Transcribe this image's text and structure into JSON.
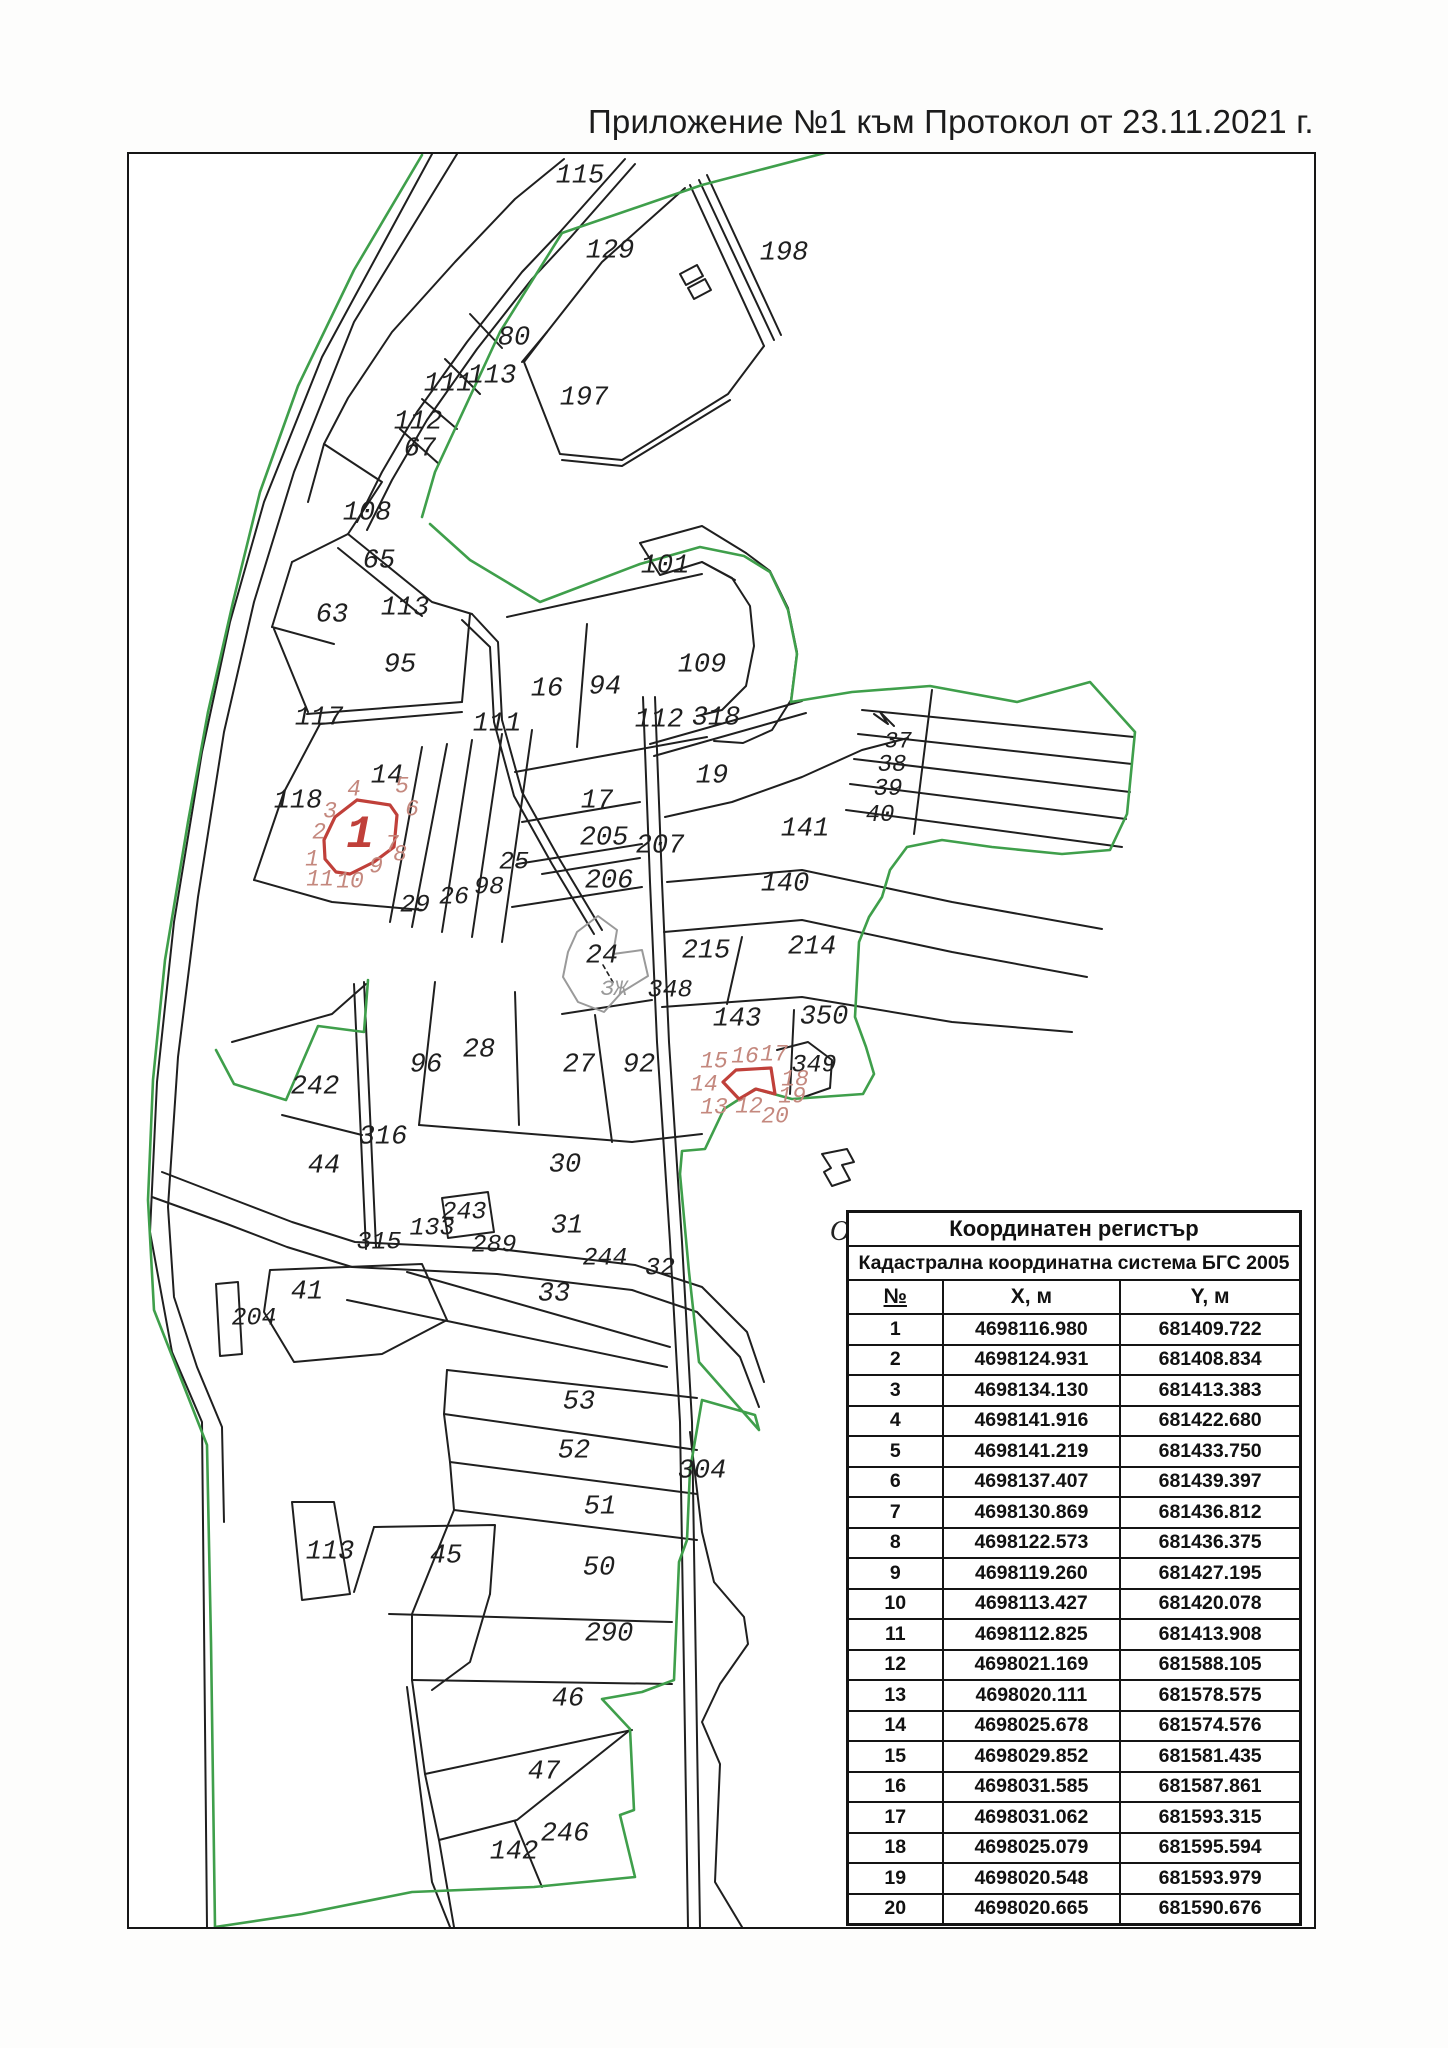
{
  "title": "Приложение №1 към Протокол от 23.11.2021 г.",
  "colors": {
    "green": "#3f9f4b",
    "red": "#c0403a",
    "pink": "#c4887e",
    "black": "#1f1f1f",
    "gray": "#9a9a9a"
  },
  "map": {
    "labels": [
      {
        "text": "115",
        "x": 578,
        "y": 175
      },
      {
        "text": "129",
        "x": 608,
        "y": 250
      },
      {
        "text": "198",
        "x": 782,
        "y": 252
      },
      {
        "text": "80",
        "x": 512,
        "y": 337
      },
      {
        "text": "113",
        "x": 490,
        "y": 375
      },
      {
        "text": "111",
        "x": 446,
        "y": 383
      },
      {
        "text": "112",
        "x": 416,
        "y": 421
      },
      {
        "text": "67",
        "x": 418,
        "y": 448
      },
      {
        "text": "197",
        "x": 582,
        "y": 397
      },
      {
        "text": "108",
        "x": 365,
        "y": 512
      },
      {
        "text": "65",
        "x": 377,
        "y": 560
      },
      {
        "text": "63",
        "x": 330,
        "y": 614
      },
      {
        "text": "113",
        "x": 403,
        "y": 607
      },
      {
        "text": "95",
        "x": 398,
        "y": 664
      },
      {
        "text": "101",
        "x": 663,
        "y": 565
      },
      {
        "text": "16",
        "x": 545,
        "y": 688
      },
      {
        "text": "94",
        "x": 603,
        "y": 686
      },
      {
        "text": "109",
        "x": 700,
        "y": 664
      },
      {
        "text": "117",
        "x": 317,
        "y": 717
      },
      {
        "text": "111",
        "x": 495,
        "y": 723
      },
      {
        "text": "112",
        "x": 657,
        "y": 719
      },
      {
        "text": "318",
        "x": 714,
        "y": 717
      },
      {
        "text": "14",
        "x": 385,
        "y": 775
      },
      {
        "text": "118",
        "x": 296,
        "y": 800
      },
      {
        "text": "19",
        "x": 710,
        "y": 775
      },
      {
        "text": "17",
        "x": 595,
        "y": 800
      },
      {
        "text": "205",
        "x": 602,
        "y": 837
      },
      {
        "text": "207",
        "x": 658,
        "y": 845
      },
      {
        "text": "206",
        "x": 607,
        "y": 880
      },
      {
        "text": "141",
        "x": 803,
        "y": 828
      },
      {
        "text": "140",
        "x": 783,
        "y": 883
      },
      {
        "text": "37",
        "x": 896,
        "y": 740,
        "size": 23
      },
      {
        "text": "38",
        "x": 890,
        "y": 764,
        "size": 24
      },
      {
        "text": "39",
        "x": 886,
        "y": 788,
        "size": 24
      },
      {
        "text": "40",
        "x": 878,
        "y": 814,
        "size": 24
      },
      {
        "text": "215",
        "x": 704,
        "y": 950
      },
      {
        "text": "214",
        "x": 810,
        "y": 946
      },
      {
        "text": "24",
        "x": 600,
        "y": 955
      },
      {
        "text": "ЗЖ",
        "x": 612,
        "y": 988,
        "kind": "gray",
        "size": 22
      },
      {
        "text": "348",
        "x": 668,
        "y": 988,
        "size": 25
      },
      {
        "text": "143",
        "x": 735,
        "y": 1018
      },
      {
        "text": "350",
        "x": 822,
        "y": 1016
      },
      {
        "text": "349",
        "x": 812,
        "y": 1063,
        "size": 25
      },
      {
        "text": "25",
        "x": 512,
        "y": 860,
        "size": 25
      },
      {
        "text": "98",
        "x": 487,
        "y": 885,
        "size": 25
      },
      {
        "text": "26",
        "x": 452,
        "y": 895,
        "size": 25
      },
      {
        "text": "29",
        "x": 413,
        "y": 903,
        "size": 25
      },
      {
        "text": "96",
        "x": 424,
        "y": 1064
      },
      {
        "text": "28",
        "x": 477,
        "y": 1049
      },
      {
        "text": "27",
        "x": 577,
        "y": 1064
      },
      {
        "text": "92",
        "x": 637,
        "y": 1064
      },
      {
        "text": "242",
        "x": 313,
        "y": 1086
      },
      {
        "text": "316",
        "x": 381,
        "y": 1136
      },
      {
        "text": "44",
        "x": 322,
        "y": 1165
      },
      {
        "text": "30",
        "x": 563,
        "y": 1164
      },
      {
        "text": "243",
        "x": 462,
        "y": 1210,
        "size": 25
      },
      {
        "text": "133",
        "x": 430,
        "y": 1226,
        "size": 25
      },
      {
        "text": "315",
        "x": 377,
        "y": 1240,
        "size": 25
      },
      {
        "text": "289",
        "x": 492,
        "y": 1243,
        "size": 25
      },
      {
        "text": "31",
        "x": 565,
        "y": 1225
      },
      {
        "text": "244",
        "x": 603,
        "y": 1256,
        "size": 25
      },
      {
        "text": "32",
        "x": 658,
        "y": 1266,
        "size": 25
      },
      {
        "text": "41",
        "x": 305,
        "y": 1291
      },
      {
        "text": "204",
        "x": 252,
        "y": 1316,
        "size": 25
      },
      {
        "text": "33",
        "x": 552,
        "y": 1293
      },
      {
        "text": "53",
        "x": 577,
        "y": 1401
      },
      {
        "text": "52",
        "x": 572,
        "y": 1450
      },
      {
        "text": "51",
        "x": 598,
        "y": 1506
      },
      {
        "text": "50",
        "x": 597,
        "y": 1567
      },
      {
        "text": "45",
        "x": 444,
        "y": 1555
      },
      {
        "text": "113",
        "x": 328,
        "y": 1551
      },
      {
        "text": "304",
        "x": 700,
        "y": 1470
      },
      {
        "text": "290",
        "x": 607,
        "y": 1633
      },
      {
        "text": "46",
        "x": 566,
        "y": 1698
      },
      {
        "text": "47",
        "x": 542,
        "y": 1771
      },
      {
        "text": "246",
        "x": 563,
        "y": 1833
      },
      {
        "text": "142",
        "x": 512,
        "y": 1851
      },
      {
        "text": "O",
        "x": 838,
        "y": 1230,
        "kind": "letter",
        "size": 28
      },
      {
        "text": "1",
        "x": 358,
        "y": 833,
        "kind": "red",
        "size": 46
      },
      {
        "text": "4",
        "x": 352,
        "y": 788,
        "kind": "pink"
      },
      {
        "text": "5",
        "x": 400,
        "y": 785,
        "kind": "pink"
      },
      {
        "text": "3",
        "x": 328,
        "y": 810,
        "kind": "pink"
      },
      {
        "text": "6",
        "x": 410,
        "y": 808,
        "kind": "pink"
      },
      {
        "text": "2",
        "x": 317,
        "y": 831,
        "kind": "pink"
      },
      {
        "text": "1",
        "x": 310,
        "y": 858,
        "kind": "pink"
      },
      {
        "text": "11",
        "x": 318,
        "y": 878,
        "kind": "pink"
      },
      {
        "text": "10",
        "x": 348,
        "y": 880,
        "kind": "pink"
      },
      {
        "text": "9",
        "x": 374,
        "y": 865,
        "kind": "pink"
      },
      {
        "text": "8",
        "x": 398,
        "y": 853,
        "kind": "pink"
      },
      {
        "text": "7",
        "x": 390,
        "y": 843,
        "kind": "pink"
      },
      {
        "text": "15",
        "x": 712,
        "y": 1060,
        "kind": "pink"
      },
      {
        "text": "16",
        "x": 743,
        "y": 1055,
        "kind": "pink"
      },
      {
        "text": "17",
        "x": 772,
        "y": 1053,
        "kind": "pink"
      },
      {
        "text": "18",
        "x": 793,
        "y": 1078,
        "kind": "pink"
      },
      {
        "text": "14",
        "x": 702,
        "y": 1083,
        "kind": "pink"
      },
      {
        "text": "13",
        "x": 712,
        "y": 1106,
        "kind": "pink"
      },
      {
        "text": "12",
        "x": 747,
        "y": 1105,
        "kind": "pink"
      },
      {
        "text": "19",
        "x": 790,
        "y": 1095,
        "kind": "pink"
      },
      {
        "text": "20",
        "x": 773,
        "y": 1115,
        "kind": "pink"
      }
    ]
  },
  "table": {
    "title": "Координатен регистър",
    "subtitle": "Кадастрална координатна система БГС 2005",
    "columns": {
      "num": "№",
      "x": "X, м",
      "y": "Y, м"
    },
    "rows": [
      [
        "1",
        "4698116.980",
        "681409.722"
      ],
      [
        "2",
        "4698124.931",
        "681408.834"
      ],
      [
        "3",
        "4698134.130",
        "681413.383"
      ],
      [
        "4",
        "4698141.916",
        "681422.680"
      ],
      [
        "5",
        "4698141.219",
        "681433.750"
      ],
      [
        "6",
        "4698137.407",
        "681439.397"
      ],
      [
        "7",
        "4698130.869",
        "681436.812"
      ],
      [
        "8",
        "4698122.573",
        "681436.375"
      ],
      [
        "9",
        "4698119.260",
        "681427.195"
      ],
      [
        "10",
        "4698113.427",
        "681420.078"
      ],
      [
        "11",
        "4698112.825",
        "681413.908"
      ],
      [
        "12",
        "4698021.169",
        "681588.105"
      ],
      [
        "13",
        "4698020.111",
        "681578.575"
      ],
      [
        "14",
        "4698025.678",
        "681574.576"
      ],
      [
        "15",
        "4698029.852",
        "681581.435"
      ],
      [
        "16",
        "4698031.585",
        "681587.861"
      ],
      [
        "17",
        "4698031.062",
        "681593.315"
      ],
      [
        "18",
        "4698025.079",
        "681595.594"
      ],
      [
        "19",
        "4698020.548",
        "681593.979"
      ],
      [
        "20",
        "4698020.665",
        "681590.676"
      ]
    ]
  }
}
